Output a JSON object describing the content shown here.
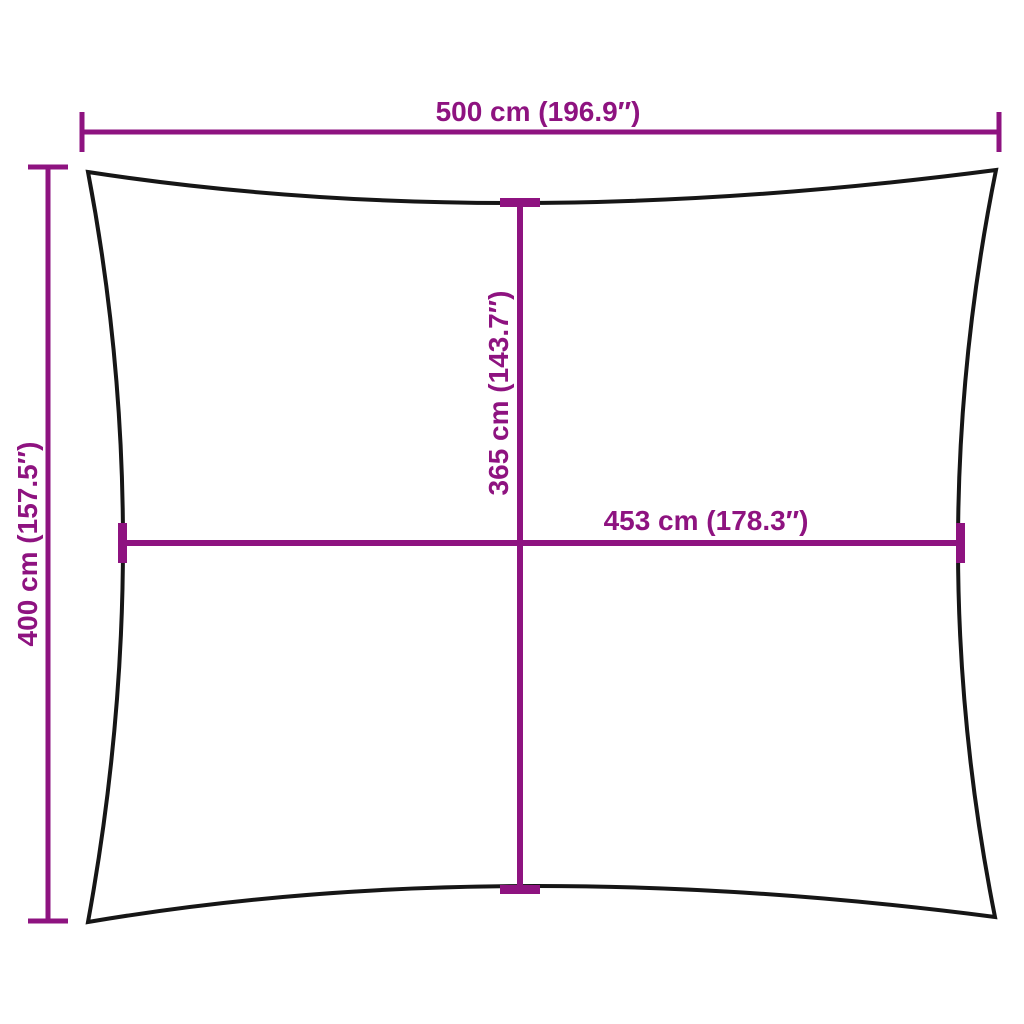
{
  "diagram": {
    "colors": {
      "accent": "#8E1380",
      "outline": "#161616",
      "background": "#FFFFFF"
    },
    "dimensions": {
      "width": {
        "label": "500 cm (196.9″)",
        "cm": 500,
        "inches": 196.9
      },
      "height": {
        "label": "400 cm (157.5″)",
        "cm": 400,
        "inches": 157.5
      },
      "inner_height": {
        "label": "365 cm (143.7″)",
        "cm": 365,
        "inches": 143.7
      },
      "inner_width": {
        "label": "453 cm (178.3″)",
        "cm": 453,
        "inches": 178.3
      }
    }
  }
}
